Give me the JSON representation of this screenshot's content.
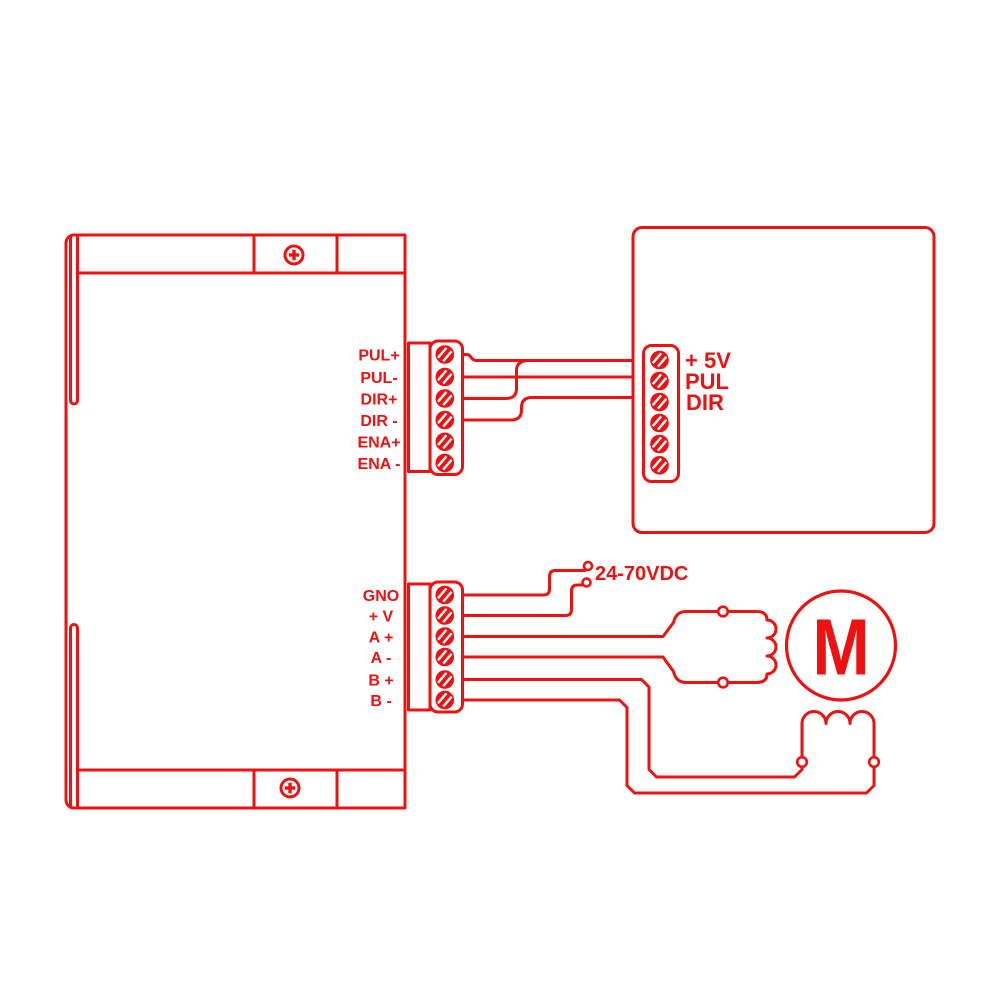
{
  "colors": {
    "line": "#ee1111",
    "background": "#ffffff",
    "screw_slot": "#ffffff"
  },
  "driver": {
    "signal_block": {
      "labels": [
        "PUL+",
        "PUL-",
        "DIR+",
        "DIR -",
        "ENA+",
        "ENA -"
      ]
    },
    "power_block": {
      "labels": [
        "GNO",
        "+ V",
        "A +",
        "A -",
        "B +",
        "B -"
      ]
    }
  },
  "controller": {
    "labels": [
      "+ 5V",
      "PUL",
      "DIR"
    ]
  },
  "power_supply": {
    "label": "24-70VDC"
  },
  "motor": {
    "label": "M"
  }
}
